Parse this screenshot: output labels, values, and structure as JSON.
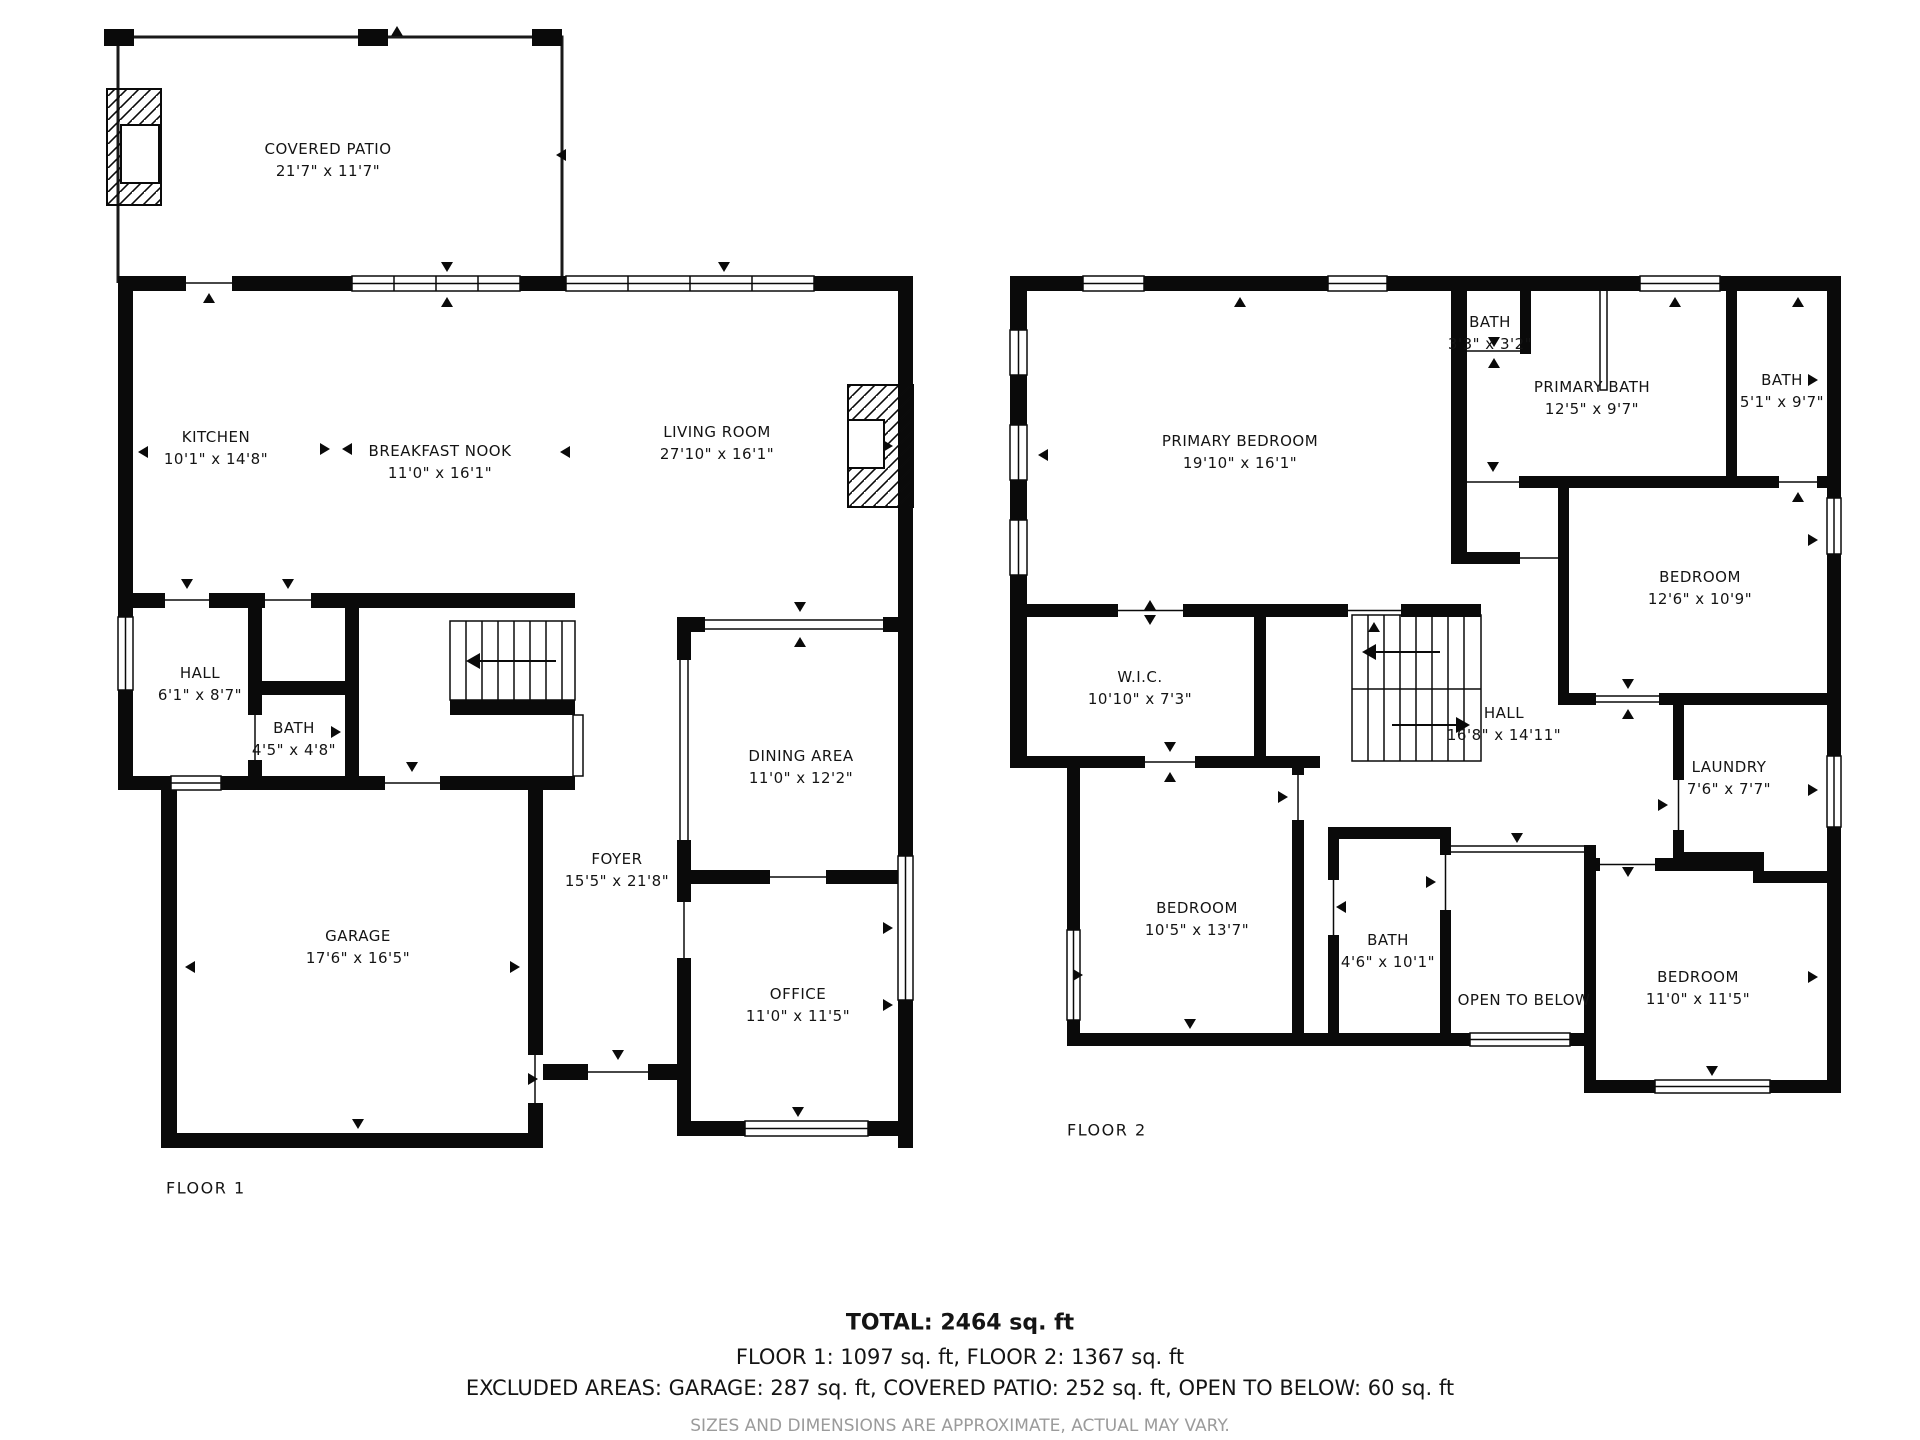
{
  "floor1": {
    "label": "FLOOR 1",
    "rooms": [
      {
        "name": "COVERED PATIO",
        "dims": "21'7\" x 11'7\""
      },
      {
        "name": "KITCHEN",
        "dims": "10'1\" x 14'8\""
      },
      {
        "name": "BREAKFAST NOOK",
        "dims": "11'0\" x 16'1\""
      },
      {
        "name": "LIVING ROOM",
        "dims": "27'10\" x 16'1\""
      },
      {
        "name": "HALL",
        "dims": "6'1\" x 8'7\""
      },
      {
        "name": "BATH",
        "dims": "4'5\" x 4'8\""
      },
      {
        "name": "DINING AREA",
        "dims": "11'0\" x 12'2\""
      },
      {
        "name": "FOYER",
        "dims": "15'5\" x 21'8\""
      },
      {
        "name": "GARAGE",
        "dims": "17'6\" x 16'5\""
      },
      {
        "name": "OFFICE",
        "dims": "11'0\" x 11'5\""
      }
    ]
  },
  "floor2": {
    "label": "FLOOR 2",
    "rooms": [
      {
        "name": "PRIMARY BEDROOM",
        "dims": "19'10\" x 16'1\""
      },
      {
        "name": "BATH",
        "dims": "3'3\" x 3'2\""
      },
      {
        "name": "PRIMARY BATH",
        "dims": "12'5\" x 9'7\""
      },
      {
        "name": "BATH",
        "dims": "5'1\" x 9'7\""
      },
      {
        "name": "BEDROOM",
        "dims": "12'6\" x 10'9\""
      },
      {
        "name": "W.I.C.",
        "dims": "10'10\" x 7'3\""
      },
      {
        "name": "HALL",
        "dims": "16'8\" x 14'11\""
      },
      {
        "name": "LAUNDRY",
        "dims": "7'6\" x 7'7\""
      },
      {
        "name": "BEDROOM",
        "dims": "10'5\" x 13'7\""
      },
      {
        "name": "BATH",
        "dims": "4'6\" x 10'1\""
      },
      {
        "name": "OPEN TO BELOW",
        "dims": ""
      },
      {
        "name": "BEDROOM",
        "dims": "11'0\" x 11'5\""
      }
    ]
  },
  "summary": {
    "total": "TOTAL: 2464 sq. ft",
    "floors": "FLOOR 1: 1097 sq. ft, FLOOR 2: 1367 sq. ft",
    "excluded": "EXCLUDED AREAS: GARAGE: 287 sq. ft, COVERED PATIO: 252 sq. ft, OPEN TO BELOW: 60 sq. ft",
    "disclaimer": "SIZES AND DIMENSIONS ARE APPROXIMATE, ACTUAL MAY VARY."
  }
}
